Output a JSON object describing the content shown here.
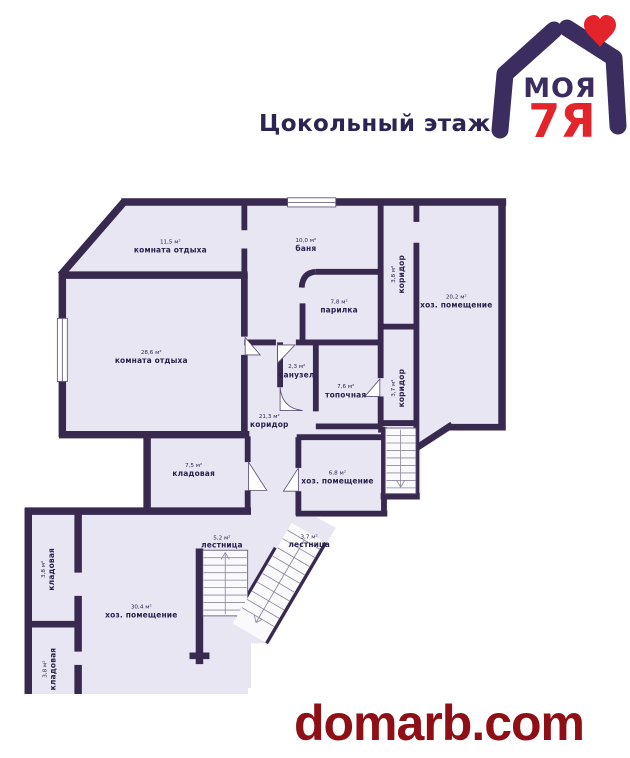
{
  "title": "Цокольный этаж",
  "logo": {
    "word_top": "МОЯ",
    "word_bottom": "7Я"
  },
  "watermark": "domarb.com",
  "rooms": [
    {
      "id": "komnata-otdyha-1",
      "name": "комната отдыха",
      "area": "11,5 м²"
    },
    {
      "id": "banya",
      "name": "баня",
      "area": "10,0 м²"
    },
    {
      "id": "koridor-verh",
      "name": "коридор",
      "area": "3,8 м²"
    },
    {
      "id": "hoz-pomeshenie-1",
      "name": "хоз. помещение",
      "area": "20,2 м²"
    },
    {
      "id": "komnata-otdyha-2",
      "name": "комната отдыха",
      "area": "28,6 м²"
    },
    {
      "id": "parilka",
      "name": "парилка",
      "area": "7,8 м²"
    },
    {
      "id": "sanuzel",
      "name": "санузел",
      "area": "2,3 м²"
    },
    {
      "id": "topochnaya",
      "name": "топочная",
      "area": "7,6 м²"
    },
    {
      "id": "koridor-glavnyi",
      "name": "коридор",
      "area": "21,3 м²"
    },
    {
      "id": "koridor-pravyi",
      "name": "коридор",
      "area": "3,7 м²"
    },
    {
      "id": "kladovaya-1",
      "name": "кладовая",
      "area": "7,5 м²"
    },
    {
      "id": "hoz-pomeshenie-2",
      "name": "хоз. помещение",
      "area": "6,8 м²"
    },
    {
      "id": "lestnitsa-1",
      "name": "лестница",
      "area": "5,2 м²"
    },
    {
      "id": "lestnitsa-2",
      "name": "лестница",
      "area": "3,7 м²"
    },
    {
      "id": "kladovaya-2",
      "name": "кладовая",
      "area": "3,8 м²"
    },
    {
      "id": "hoz-pomeshenie-3",
      "name": "хоз. помещение",
      "area": "30,4 м²"
    },
    {
      "id": "kladovaya-3",
      "name": "кладовая",
      "area": "3,8 м²"
    }
  ],
  "colors": {
    "wall": "#38294e",
    "floor": "#e9e6f3",
    "stair": "#fafafd",
    "stairline": "#8c87a0",
    "outline": "#5c5073",
    "label": "#29224a",
    "title": "#2c2453",
    "logoPurple": "#3b2d5f",
    "logoRed": "#e3242b",
    "watermark": "#8e1016"
  }
}
